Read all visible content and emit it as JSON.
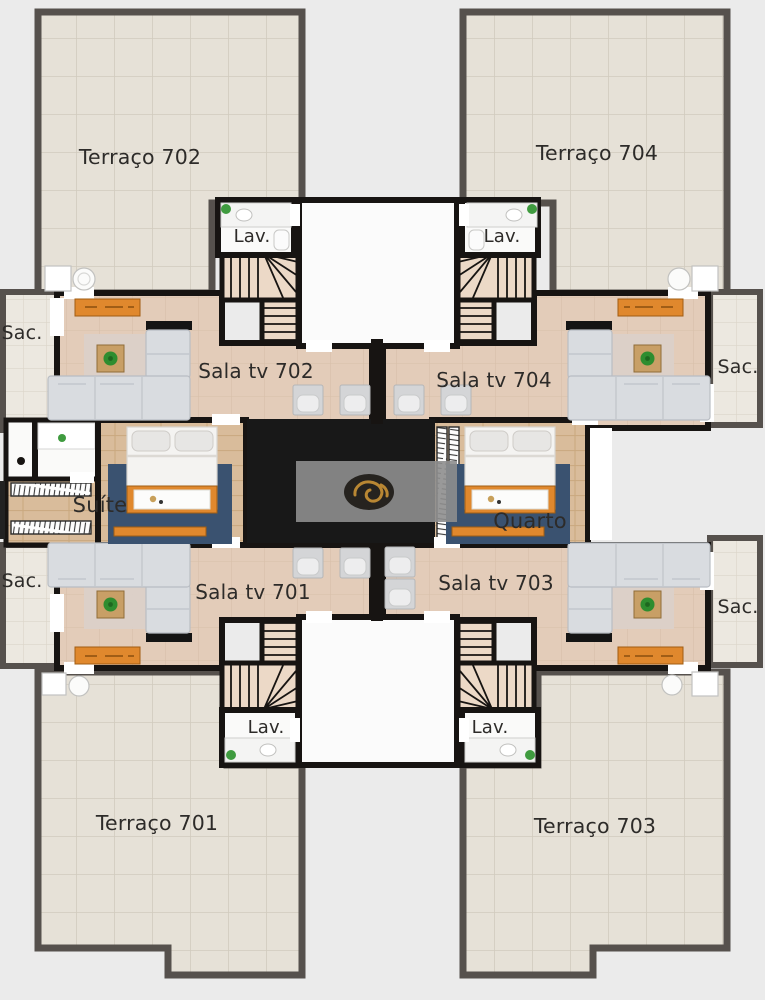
{
  "page": {
    "background_color": "#ebebeb"
  },
  "floorplan": {
    "units": [
      {
        "number": "702",
        "terrace_label": "Terraço 702",
        "living_label": "Sala tv 702"
      },
      {
        "number": "704",
        "terrace_label": "Terraço 704",
        "living_label": "Sala tv 704"
      },
      {
        "number": "701",
        "terrace_label": "Terraço 701",
        "living_label": "Sala tv 701"
      },
      {
        "number": "703",
        "terrace_label": "Terraço 703",
        "living_label": "Sala tv 703"
      }
    ],
    "bedrooms": {
      "suite_label": "Suíte",
      "bedroom_label": "Quarto"
    },
    "service": {
      "lavatory_label": "Lav.",
      "balcony_label": "Sac."
    },
    "colors": {
      "background": "#ebebeb",
      "terrace_tile": "#e6e1d7",
      "balcony_tile": "#ece8e0",
      "living_floor": "#e3ccb9",
      "wood_floor": "#d9bc9b",
      "outer_wall": "#56514d",
      "inner_wall": "#171412",
      "elevator_core": "#181818",
      "furniture_orange": "#e0882d",
      "rug_navy": "#3a5270",
      "sofa_gray": "#d9dce0",
      "watermark_gray": "#8e8e8e",
      "logo_gold": "#b98733"
    }
  }
}
